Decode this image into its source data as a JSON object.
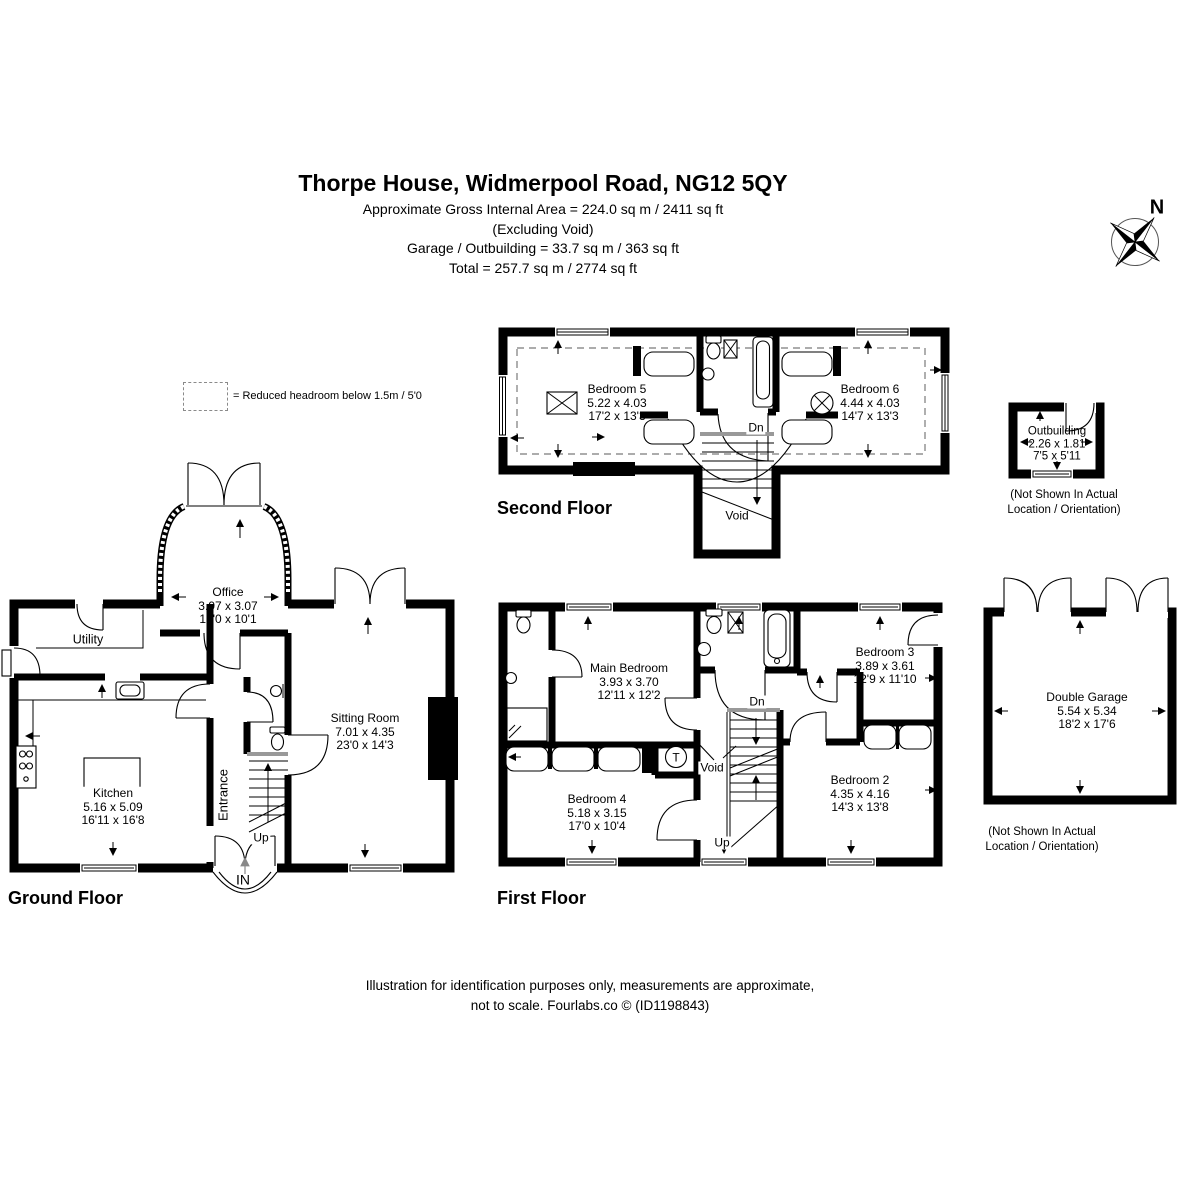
{
  "header": {
    "title": "Thorpe House, Widmerpool Road, NG12 5QY",
    "line1": "Approximate Gross Internal Area = 224.0 sq m / 2411 sq ft",
    "line2": "(Excluding Void)",
    "line3": "Garage / Outbuilding = 33.7 sq m / 363 sq ft",
    "line4": "Total = 257.7 sq m / 2774 sq ft"
  },
  "compass": {
    "north": "N"
  },
  "legend": {
    "text": "= Reduced headroom below 1.5m / 5'0"
  },
  "second_floor": {
    "title": "Second Floor",
    "bedroom5": {
      "name": "Bedroom 5",
      "metric": "5.22 x 4.03",
      "imperial": "17'2 x 13'3"
    },
    "bedroom6": {
      "name": "Bedroom 6",
      "metric": "4.44 x 4.03",
      "imperial": "14'7 x 13'3"
    },
    "dn": "Dn",
    "void_label": "Void"
  },
  "outbuilding": {
    "name": "Outbuilding",
    "metric": "2.26 x 1.81",
    "imperial": "7'5 x 5'11",
    "note1": "(Not Shown In Actual",
    "note2": "Location / Orientation)"
  },
  "ground_floor": {
    "title": "Ground Floor",
    "office": {
      "name": "Office",
      "metric": "3.97 x 3.07",
      "imperial": "13'0 x 10'1"
    },
    "utility": {
      "name": "Utility"
    },
    "kitchen": {
      "name": "Kitchen",
      "metric": "5.16 x 5.09",
      "imperial": "16'11 x 16'8"
    },
    "sitting_room": {
      "name": "Sitting Room",
      "metric": "7.01 x 4.35",
      "imperial": "23'0 x 14'3"
    },
    "entrance": {
      "name": "Entrance"
    },
    "up": "Up",
    "in_label": "IN"
  },
  "first_floor": {
    "title": "First Floor",
    "main_bedroom": {
      "name": "Main Bedroom",
      "metric": "3.93 x 3.70",
      "imperial": "12'11 x 12'2"
    },
    "bedroom2": {
      "name": "Bedroom 2",
      "metric": "4.35 x 4.16",
      "imperial": "14'3 x 13'8"
    },
    "bedroom3": {
      "name": "Bedroom 3",
      "metric": "3.89 x 3.61",
      "imperial": "12'9 x 11'10"
    },
    "bedroom4": {
      "name": "Bedroom 4",
      "metric": "5.18 x 3.15",
      "imperial": "17'0 x 10'4"
    },
    "dn": "Dn",
    "up": "Up",
    "void_label": "Void",
    "tank": "T"
  },
  "garage": {
    "name": "Double Garage",
    "metric": "5.54 x 5.34",
    "imperial": "18'2 x 17'6",
    "note1": "(Not Shown In Actual",
    "note2": "Location / Orientation)"
  },
  "footer": {
    "line1": "Illustration for identification purposes only, measurements are approximate,",
    "line2": "not to scale. Fourlabs.co © (ID1198843)"
  }
}
